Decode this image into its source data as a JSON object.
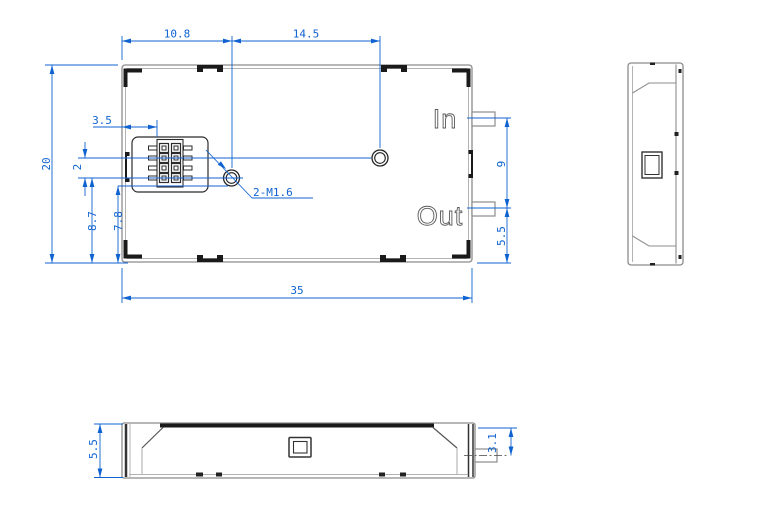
{
  "drawing": {
    "front_view": {
      "dim_top_left_width": "10.8",
      "dim_top_right_width": "14.5",
      "dim_connector_offset": "3.5",
      "dim_hole_row_gap": "2",
      "dim_overall_height": "20",
      "dim_hole_to_bottom": "8.7",
      "dim_connector_to_bottom": "7.8",
      "dim_overall_width": "35",
      "dim_port_pitch": "9",
      "dim_port_to_bottom": "5.5",
      "hole_callout": "2-M1.6",
      "label_in": "In",
      "label_out": "Out"
    },
    "bottom_view": {
      "dim_body_height": "5.5",
      "dim_pin_offset": "3.1"
    },
    "colors": {
      "dimension_blue": "#0f63d0",
      "outline_gray": "#8c8c8c",
      "feature_black": "#1a1a1a"
    }
  }
}
